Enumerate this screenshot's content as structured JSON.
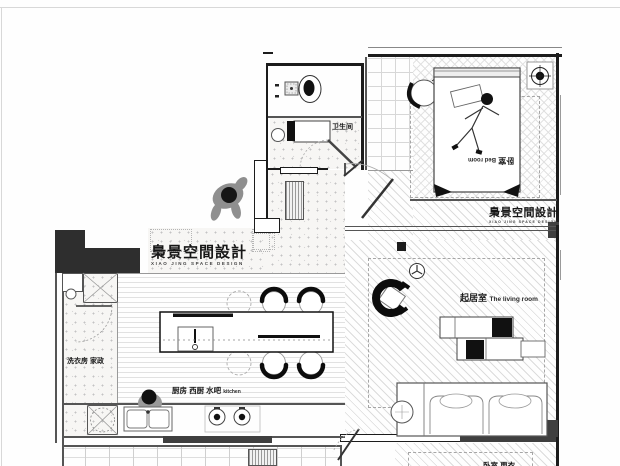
{
  "plan": {
    "title": "apartment floor plan",
    "watermark_center": {
      "cn": "梟景空間設計",
      "en": "XIAO JING SPACE DESIGN"
    },
    "watermark_bedroom": {
      "cn": "梟景空間設計",
      "en": "XIAO JING SPACE DESIGN"
    },
    "rooms": {
      "bathroom": {
        "label": "卫生间"
      },
      "bedroom": {
        "label_cn": "卧室",
        "label_en": "Bed room"
      },
      "living": {
        "label_cn": "起居室",
        "label_en": "The living room"
      },
      "laundry": {
        "label": "洗衣房 家政"
      },
      "kitchen": {
        "label_cn": "厨房 西厨 水吧",
        "label_en": "kitchen"
      },
      "bottom_room": {
        "label": "卧室 更衣"
      }
    },
    "colors": {
      "wall": "#1c1c1c",
      "dark_fill": "#3f3f3f",
      "pattern_line": "#dcdcdc",
      "ink": "#111111"
    }
  }
}
